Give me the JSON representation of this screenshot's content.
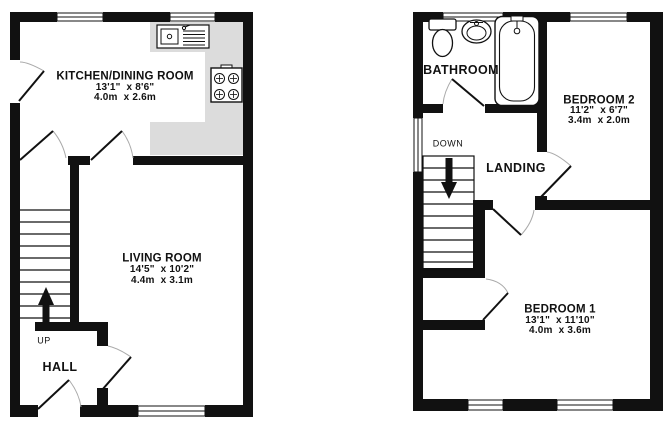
{
  "floorplan": {
    "floors": {
      "ground": {
        "rooms": {
          "kitchen": {
            "name": "KITCHEN/DINING ROOM",
            "imperial": "13'1\"  x 8'6\"",
            "metric": "4.0m  x 2.6m"
          },
          "living": {
            "name": "LIVING ROOM",
            "imperial": "14'5\"  x 10'2\"",
            "metric": "4.4m  x 3.1m"
          },
          "hall": {
            "name": "HALL"
          }
        },
        "stairs_label": "UP",
        "fixtures": [
          "sink",
          "hob"
        ]
      },
      "first": {
        "rooms": {
          "bathroom": {
            "name": "BATHROOM"
          },
          "bedroom2": {
            "name": "BEDROOM 2",
            "imperial": "11'2\"  x 6'7\"",
            "metric": "3.4m  x 2.0m"
          },
          "bedroom1": {
            "name": "BEDROOM 1",
            "imperial": "13'1\"  x 11'10\"",
            "metric": "4.0m  x 3.6m"
          },
          "landing": {
            "name": "LANDING"
          }
        },
        "stairs_label": "DOWN",
        "fixtures": [
          "toilet",
          "basin",
          "bathtub"
        ]
      }
    },
    "colors": {
      "wall": "#111111",
      "counter": "#dcdcdc",
      "door_arc": "#aaaaaa",
      "background": "#ffffff",
      "text": "#111111"
    }
  }
}
